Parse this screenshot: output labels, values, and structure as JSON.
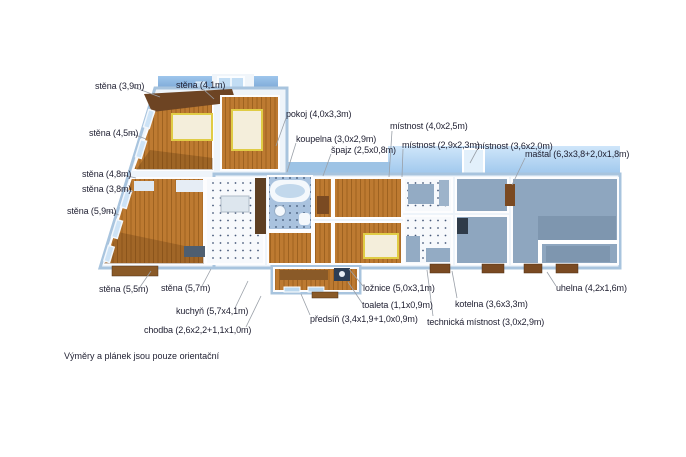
{
  "plan": {
    "title": "floor-plan",
    "footer_note": "Výměry a plánek jsou pouze orientační",
    "labels": [
      {
        "id": "stena-3-9",
        "text": "stěna (3,9m)"
      },
      {
        "id": "stena-4-1",
        "text": "stěna (4,1m)"
      },
      {
        "id": "stena-4-5",
        "text": "stěna (4,5m)"
      },
      {
        "id": "stena-4-8",
        "text": "stěna (4,8m)"
      },
      {
        "id": "stena-3-8",
        "text": "stěna (3,8m)"
      },
      {
        "id": "stena-5-9",
        "text": "stěna (5,9m)"
      },
      {
        "id": "pokoj",
        "text": "pokoj (4,0x3,3m)"
      },
      {
        "id": "koupelna",
        "text": "koupelna (3,0x2,9m)"
      },
      {
        "id": "spajz",
        "text": "špajz (2,5x0,8m)"
      },
      {
        "id": "mistnost-4-0",
        "text": "místnost (4,0x2,5m)"
      },
      {
        "id": "mistnost-2-9",
        "text": "místnost (2,9x2,3m)"
      },
      {
        "id": "mistnost-3-6",
        "text": "místnost (3,6x2,0m)"
      },
      {
        "id": "mastal",
        "text": "maštal (6,3x3,8+2,0x1,8m)"
      },
      {
        "id": "stena-5-5",
        "text": "stěna (5,5m)"
      },
      {
        "id": "stena-5-7",
        "text": "stěna (5,7m)"
      },
      {
        "id": "kuchyn",
        "text": "kuchyň (5,7x4,1m)"
      },
      {
        "id": "chodba",
        "text": "chodba (2,6x2,2+1,1x1,0m)"
      },
      {
        "id": "predsin",
        "text": "předsíň (3,4x1,9+1,0x0,9m)"
      },
      {
        "id": "toaleta",
        "text": "toaleta (1,1x0,9m)"
      },
      {
        "id": "loznice",
        "text": "ložnice (5,0x3,1m)"
      },
      {
        "id": "technicka-mistnost",
        "text": "technická místnost (3,0x2,9m)"
      },
      {
        "id": "kotelna",
        "text": "kotelna (3,6x3,3m)"
      },
      {
        "id": "uhelna",
        "text": "uhelna (4,2x1,6m)"
      }
    ],
    "colors": {
      "wood_floor": "#bd7a31",
      "wood_dark": "#6d4423",
      "tile_white": "#f7f9fc",
      "tile_blue": "#a9c2de",
      "utility_floor": "#8ea6bf",
      "wall_slab": "#eef4fa",
      "wall_edge": "#a8c4de",
      "band_dark_blue": "#5585bd",
      "band_light_blue": "#a9d0f0",
      "bed_fill": "#f4eedb",
      "bed_outline": "#e0cc45",
      "label_text": "#1e1e30"
    }
  }
}
